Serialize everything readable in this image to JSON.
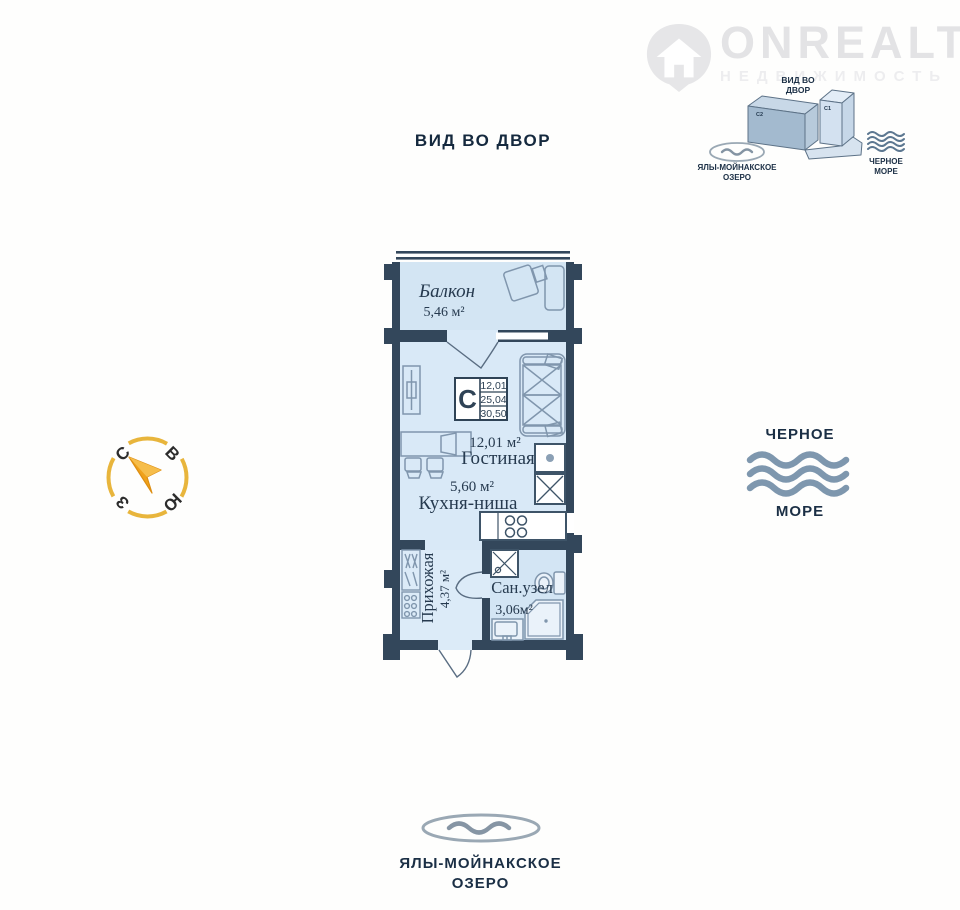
{
  "logo": {
    "name": "ONREALT",
    "tagline": "НЕДВИЖИМОСТЬ"
  },
  "header": {
    "view_label": "ВИД ВО ДВОР"
  },
  "minimap": {
    "view_line1": "ВИД ВО",
    "view_line2": "ДВОР",
    "building_c2": "С2",
    "building_c1": "С1",
    "lake_line1": "ЯЛЫ-МОЙНАКСКОЕ",
    "lake_line2": "ОЗЕРО",
    "sea_line1": "ЧЕРНОЕ",
    "sea_line2": "МОРЕ"
  },
  "compass": {
    "north": "С",
    "east": "В",
    "west": "З",
    "south": "Ю"
  },
  "plan": {
    "balcony_name": "Балкон",
    "balcony_area": "5,46 м²",
    "info_letter": "С",
    "info_value1": "12,01",
    "info_value2": "25,04",
    "info_value3": "30,50",
    "living_area": "12,01 м²",
    "living_name": "Гостиная",
    "kitchen_area": "5,60 м²",
    "kitchen_name": "Кухня-ниша",
    "hall_name": "Прихожая",
    "hall_area": "4,37 м²",
    "bath_name": "Сан.узел",
    "bath_area": "3,06м²"
  },
  "sea": {
    "line1": "ЧЕРНОЕ",
    "line2": "МОРЕ"
  },
  "lake": {
    "line1": "ЯЛЫ-МОЙНАКСКОЕ",
    "line2": "ОЗЕРО"
  },
  "colors": {
    "wall": "#33475b",
    "floor": "#d7e7f6",
    "accent_text": "#1b2f45",
    "furniture": "#8096ad",
    "fixture_dark": "#3e5468",
    "compass_gold": "#e8b53c",
    "needle_orange": "#f0a11a",
    "wave_blue": "#7e97ae"
  }
}
